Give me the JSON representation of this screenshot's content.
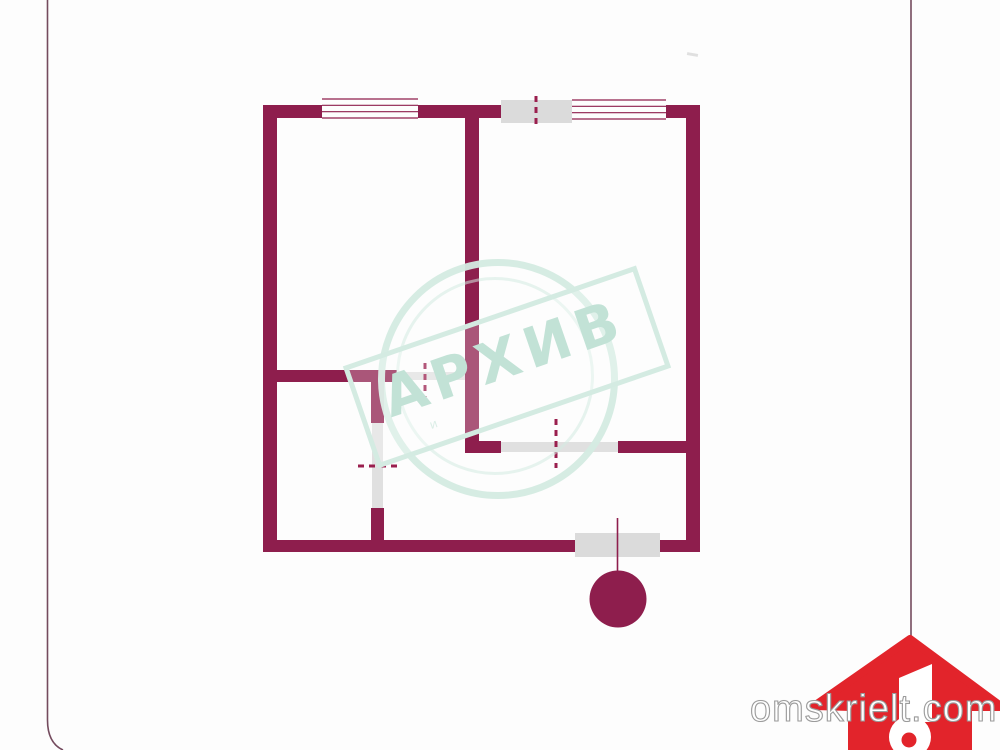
{
  "colors": {
    "wall": "#8E1E4D",
    "dash": "#9A1F4E",
    "gray": "#DBDBDB",
    "leaf": "#E0E0E0",
    "mint": "#D4EBE2",
    "mintText": "#C2E2D6",
    "logoRed": "#E2242B",
    "frame": "#5C2B42",
    "background": "#FDFDFD"
  },
  "watermark": {
    "big_text": "АРХИВ",
    "small_text": "и"
  },
  "logo": {
    "text": "omskrielt.com"
  },
  "plan": {
    "rects": [
      {
        "name": "wall-left-outer",
        "x": 263,
        "y": 105,
        "w": 14,
        "h": 447,
        "fill": "wall"
      },
      {
        "name": "wall-top-segment-a",
        "x": 263,
        "y": 105,
        "w": 59,
        "h": 13,
        "fill": "wall"
      },
      {
        "name": "wall-top-segment-b",
        "x": 418,
        "y": 105,
        "w": 83,
        "h": 13,
        "fill": "wall"
      },
      {
        "name": "wall-top-segment-c",
        "x": 666,
        "y": 105,
        "w": 34,
        "h": 13,
        "fill": "wall"
      },
      {
        "name": "wall-right-outer",
        "x": 686,
        "y": 105,
        "w": 14,
        "h": 447,
        "fill": "wall"
      },
      {
        "name": "wall-bottom-segment-a",
        "x": 263,
        "y": 540,
        "w": 312,
        "h": 12,
        "fill": "wall"
      },
      {
        "name": "wall-bottom-segment-b",
        "x": 660,
        "y": 540,
        "w": 40,
        "h": 12,
        "fill": "wall"
      },
      {
        "name": "wall-partition-central",
        "x": 465,
        "y": 118,
        "w": 14,
        "h": 335,
        "fill": "wall"
      },
      {
        "name": "wall-room2-bottom-left",
        "x": 465,
        "y": 441,
        "w": 36,
        "h": 12,
        "fill": "wall"
      },
      {
        "name": "wall-room2-bottom-right",
        "x": 618,
        "y": 441,
        "w": 68,
        "h": 12,
        "fill": "wall"
      },
      {
        "name": "wall-hall-top",
        "x": 263,
        "y": 370,
        "w": 134,
        "h": 12,
        "fill": "wall"
      },
      {
        "name": "wall-hall-vertical-upper",
        "x": 371,
        "y": 380,
        "w": 13,
        "h": 43,
        "fill": "wall"
      },
      {
        "name": "wall-hall-vertical-lower",
        "x": 371,
        "y": 508,
        "w": 13,
        "h": 32,
        "fill": "wall"
      },
      {
        "name": "balcony-door-top-block",
        "x": 501,
        "y": 100,
        "w": 71,
        "h": 23,
        "fill": "gray"
      },
      {
        "name": "balcony-door-bottom-block",
        "x": 575,
        "y": 533,
        "w": 85,
        "h": 24,
        "fill": "gray"
      },
      {
        "name": "door-opening-room2",
        "x": 501,
        "y": 442,
        "w": 117,
        "h": 10,
        "fill": "leaf"
      },
      {
        "name": "door-opening-room1",
        "x": 397,
        "y": 372,
        "w": 68,
        "h": 8,
        "fill": "leaf"
      },
      {
        "name": "door-opening-hall",
        "x": 372,
        "y": 423,
        "w": 11,
        "h": 85,
        "fill": "leaf"
      }
    ],
    "windows": [
      {
        "name": "window-top-left",
        "x": 322,
        "x2": 418,
        "yTop": 99,
        "yBot": 118,
        "lines": 4
      },
      {
        "name": "window-top-right",
        "x": 572,
        "x2": 666,
        "yTop": 100,
        "yBot": 119,
        "lines": 4
      }
    ],
    "dashes": [
      {
        "name": "door-swing-balcony-top",
        "x1": 536,
        "y1": 96,
        "x2": 536,
        "y2": 129
      },
      {
        "name": "door-swing-room1",
        "x1": 425,
        "y1": 363,
        "x2": 425,
        "y2": 397
      },
      {
        "name": "door-swing-room2",
        "x1": 556,
        "y1": 419,
        "x2": 556,
        "y2": 468
      },
      {
        "name": "door-swing-hall",
        "x1": 358,
        "y1": 466,
        "x2": 398,
        "y2": 466
      }
    ],
    "marker": {
      "name": "entrance-marker",
      "line": {
        "x": 617.5,
        "y1": 518,
        "y2": 572
      },
      "circle": {
        "cx": 618,
        "cy": 599,
        "r": 28.5
      }
    }
  }
}
